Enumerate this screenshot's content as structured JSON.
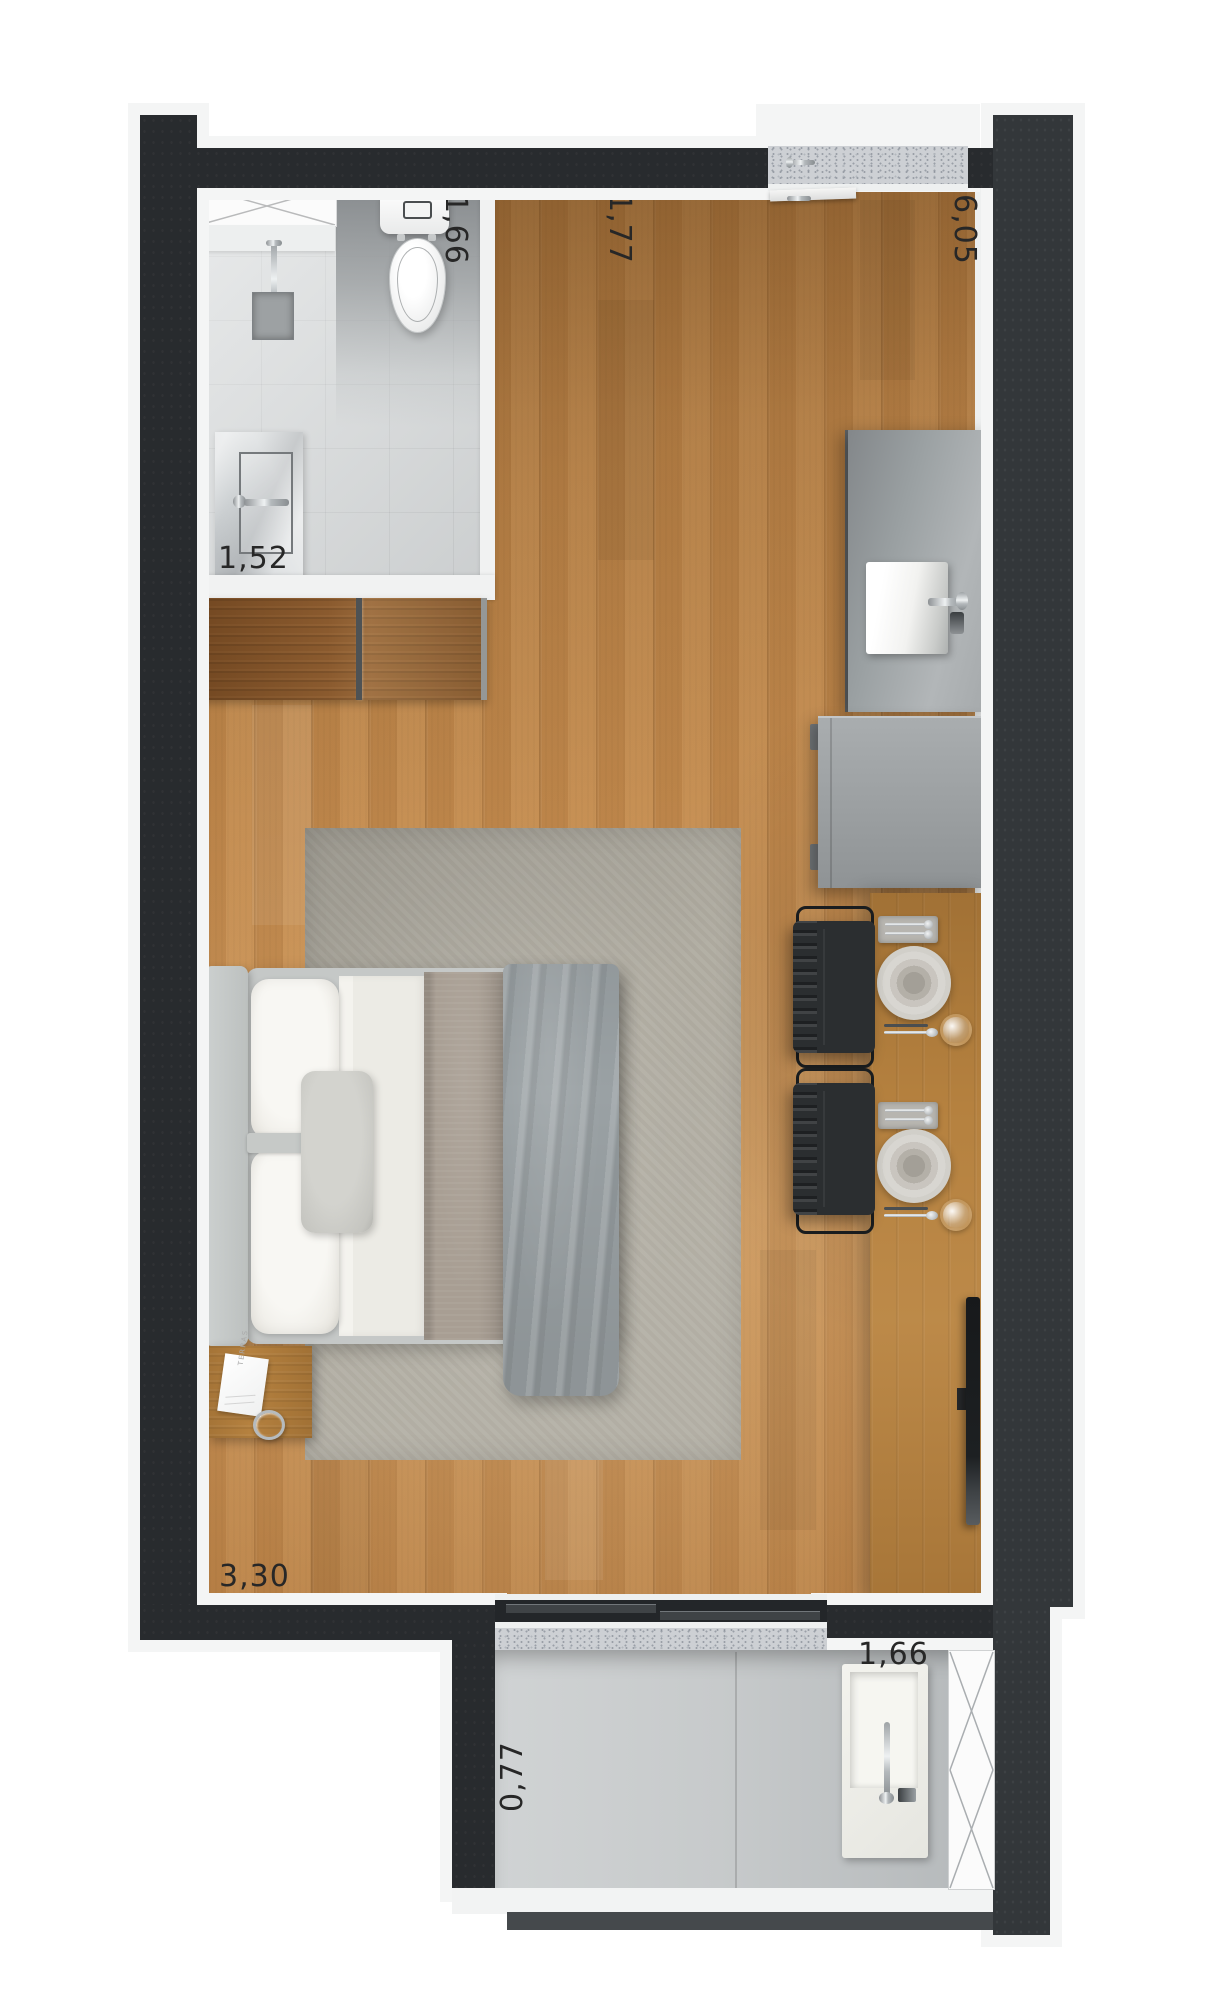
{
  "meta": {
    "title": "Studio apartment floor plan – rendered top view"
  },
  "labels": {
    "bathroom_width": "1,66",
    "hall_width": "1,77",
    "unit_length": "6,05",
    "vanity_width": "1,52",
    "room_width": "3,30",
    "balcony_depth": "0,77",
    "balcony_width": "1,66",
    "card_brand": "TERRAS"
  },
  "palette": {
    "background": "#ffffff",
    "wall_dark": "#282b2e",
    "wall_light": "#33373a",
    "floor_wood": "#c48c50",
    "furniture_wood": "#b5813f",
    "wardrobe_wood": "#8a5a2e",
    "tile": "#d7dadb",
    "counter_concrete": "#9aa0a3",
    "rug": "#b1ada2",
    "bedding_white": "#f2f1ec",
    "duvet_gray": "#9aa1a4",
    "chrome": "#dfe3e4"
  },
  "rooms": [
    "bathroom",
    "hall",
    "kitchen",
    "living-bedroom",
    "balcony"
  ],
  "furniture": [
    "shower",
    "toilet",
    "vanity-sink",
    "wardrobe",
    "kitchen-counter",
    "kitchen-sink",
    "refrigerator",
    "dining-table",
    "dining-chair",
    "place-setting",
    "double-bed",
    "nightstand",
    "area-rug",
    "tv",
    "laundry-sink",
    "sliding-door",
    "entry-door"
  ]
}
